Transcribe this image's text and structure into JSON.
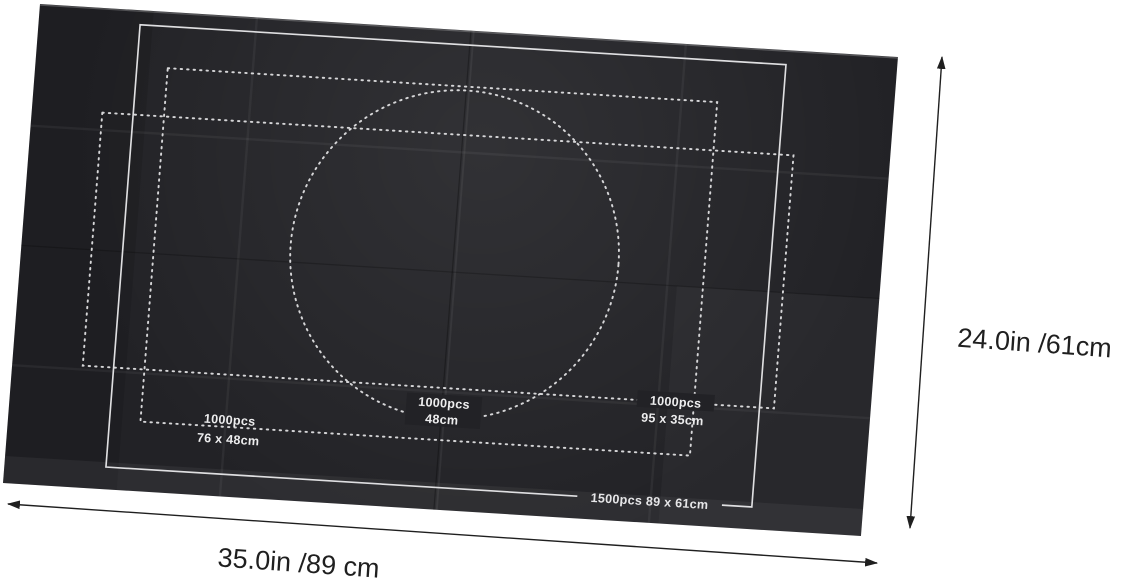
{
  "mat_labels": {
    "circle": {
      "line1": "1000pcs",
      "line2": "48cm"
    },
    "left_rect": {
      "line1": "1000pcs",
      "line2": "76  x 48cm"
    },
    "right_rect": {
      "line1": "1000pcs",
      "line2": "95 x 35cm"
    },
    "outer_rect": {
      "label": "1500pcs 89  x 61cm"
    }
  },
  "dimensions": {
    "height_label": "24.0in /61cm",
    "width_label": "35.0in /89 cm"
  },
  "colors": {
    "background": "#ffffff",
    "mat": "#222226",
    "guide_line": "#d6d6d8",
    "outline": "#dfdfe1",
    "annotation": "#1f1f1f"
  }
}
